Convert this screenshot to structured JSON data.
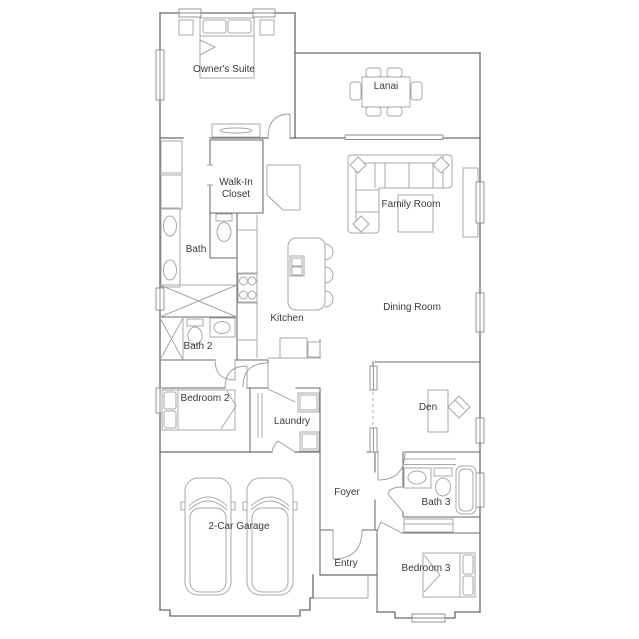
{
  "floorplan": {
    "rooms": {
      "owners_suite": "Owner's Suite",
      "lanai": "Lanai",
      "walk_in_closet_line1": "Walk-In",
      "walk_in_closet_line2": "Closet",
      "family_room": "Family Room",
      "bath": "Bath",
      "kitchen": "Kitchen",
      "dining_room": "Dining Room",
      "bath_2": "Bath 2",
      "bedroom_2": "Bedroom 2",
      "laundry": "Laundry",
      "den": "Den",
      "foyer": "Foyer",
      "bath_3": "Bath 3",
      "garage": "2-Car Garage",
      "entry": "Entry",
      "bedroom_3": "Bedroom 3"
    },
    "colors": {
      "background": "#ffffff",
      "wall": "#6a6a6a",
      "furniture": "#a8a8a8",
      "door": "#9a9a9a",
      "window": "#8a8a8a",
      "label": "#3a3a3a"
    }
  }
}
